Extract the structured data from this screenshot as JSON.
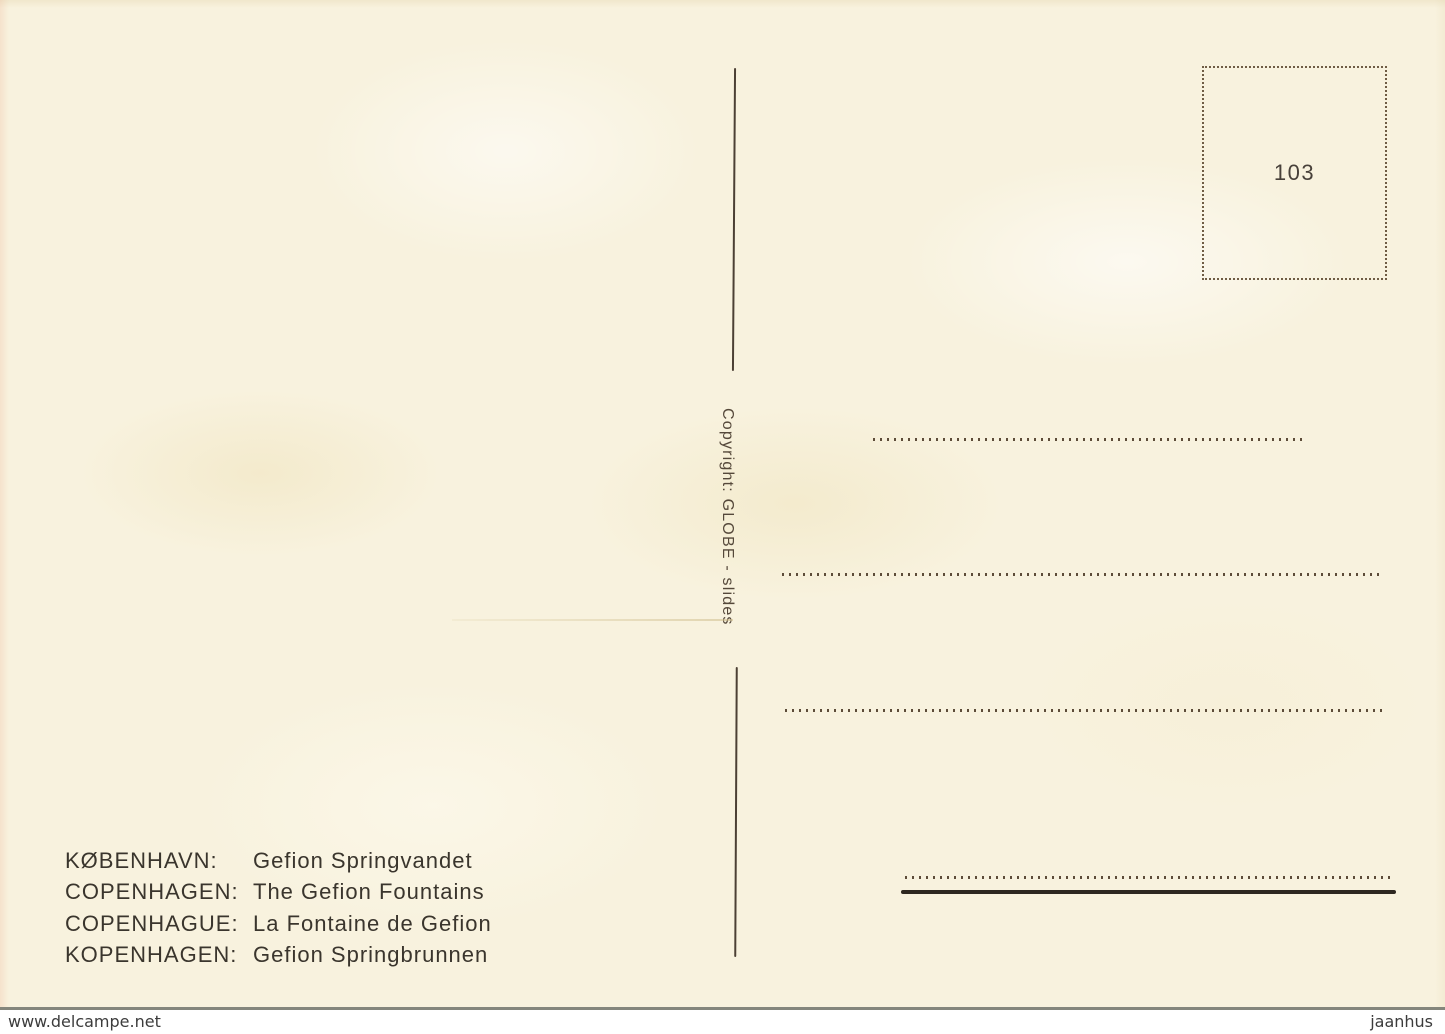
{
  "postcard": {
    "stamp_box": {
      "number": "103"
    },
    "copyright_vertical": "Copyright: GLOBE - slides",
    "captions": [
      {
        "label": "KØBENHAVN:",
        "text": "Gefion Springvandet"
      },
      {
        "label": "COPENHAGEN:",
        "text": "The Gefion Fountains"
      },
      {
        "label": "COPENHAGUE:",
        "text": "La Fontaine de Gefion"
      },
      {
        "label": "KOPENHAGEN:",
        "text": "Gefion Springbrunnen"
      }
    ],
    "colors": {
      "card_background": "#f8f2de",
      "ink": "#3a352d",
      "dotted_lines": "#5d4c39",
      "heavy_line": "#2e2820",
      "stamp_border": "#6f5c44"
    }
  },
  "watermarks": {
    "left": "www.delcampe.net",
    "right": "jaanhus"
  }
}
